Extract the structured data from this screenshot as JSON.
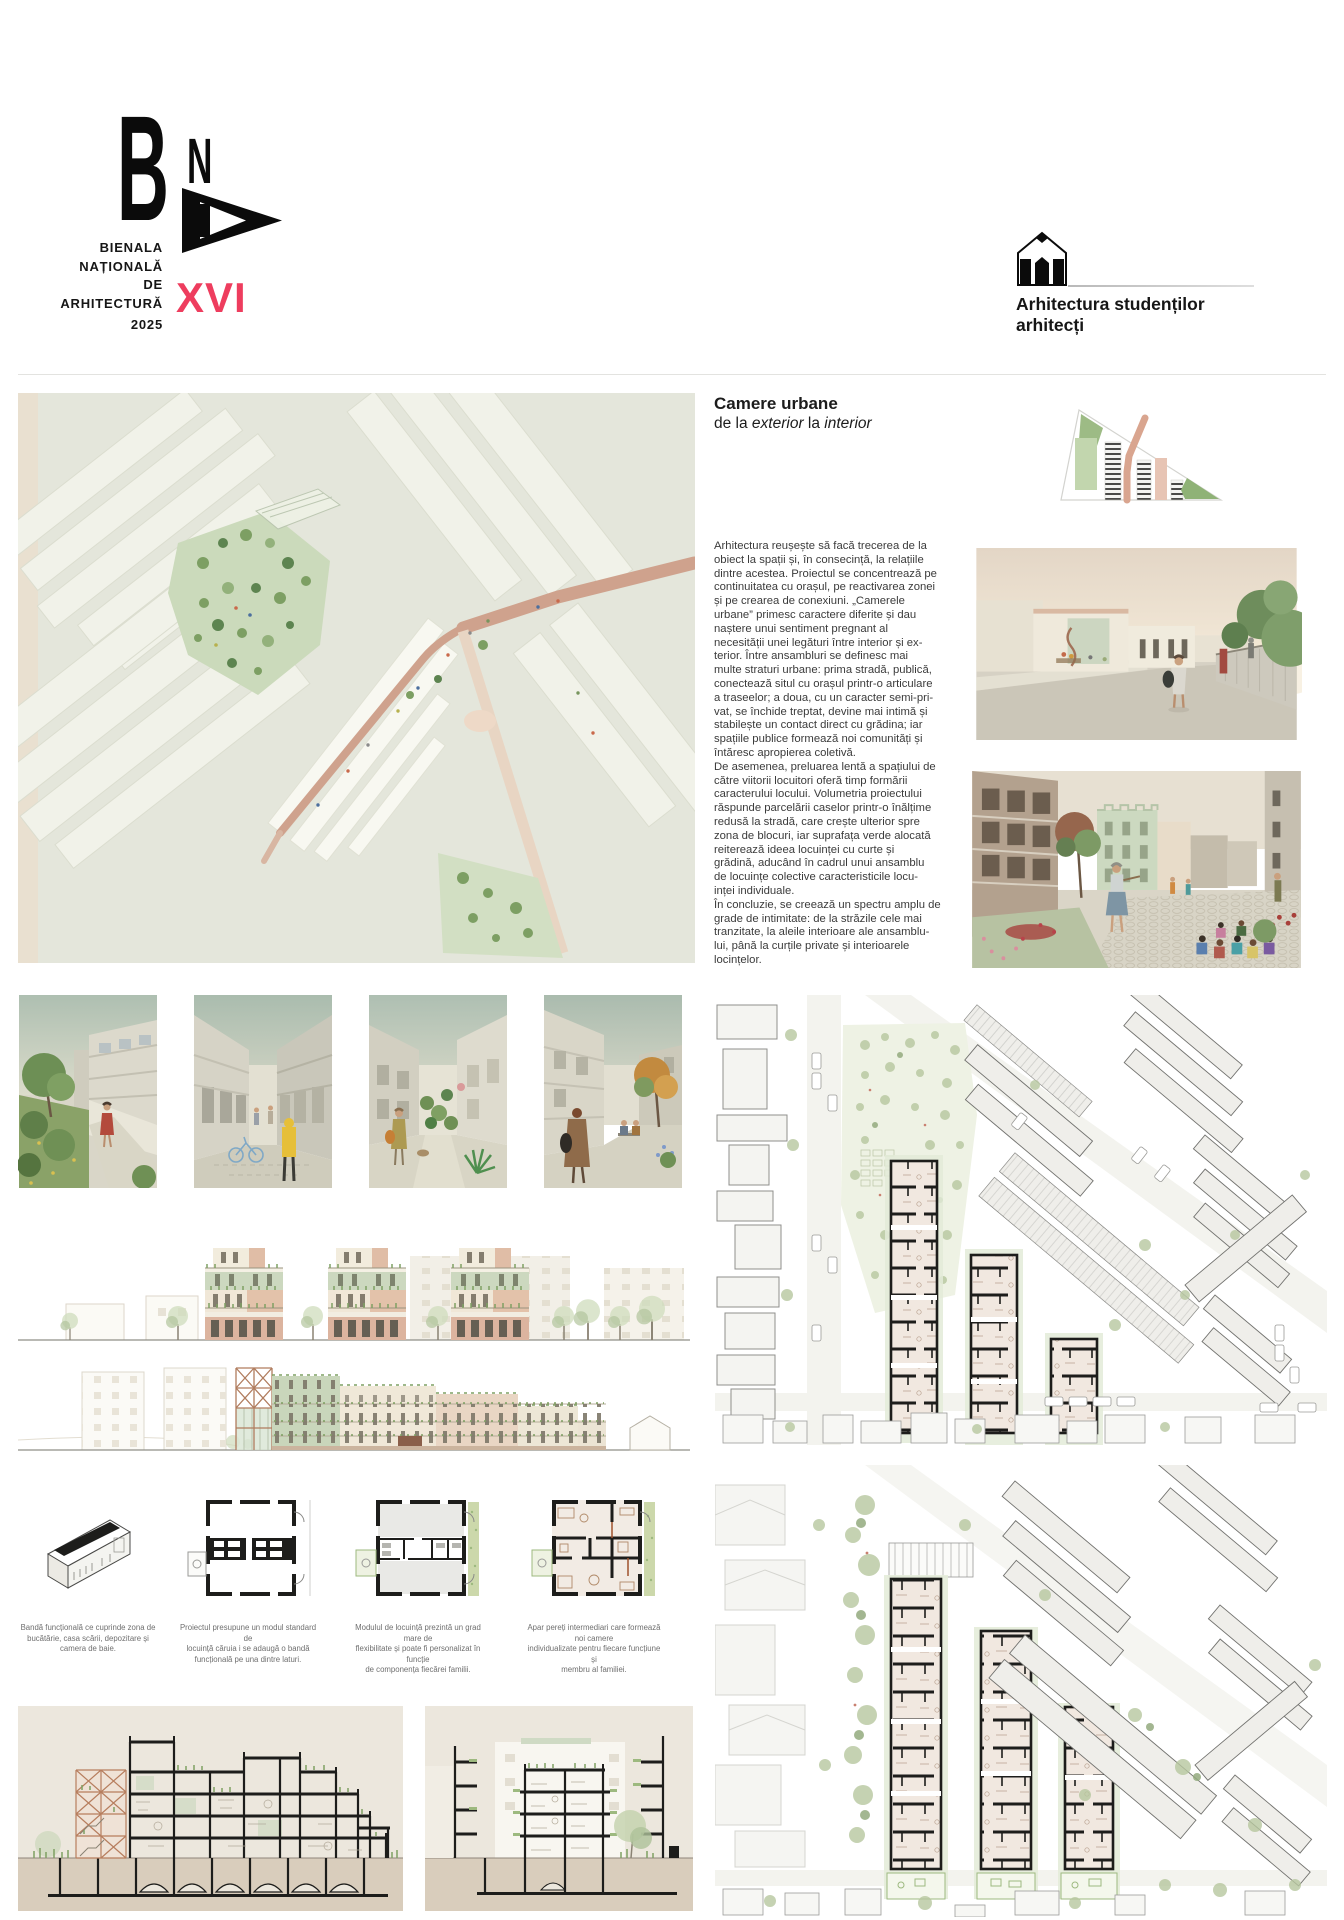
{
  "brand": {
    "letter_b": "B",
    "letter_n": "N",
    "title_lines": [
      "BIENALA",
      "NAȚIONALĂ",
      "DE",
      "ARHITECTURĂ"
    ],
    "year": "2025",
    "edition": "XVI",
    "accent_color": "#ee3d5e"
  },
  "category": {
    "label": "Arhitectura studenților arhitecți",
    "icon": "pencil-house-icon"
  },
  "project": {
    "title": "Camere urbane",
    "subtitle": {
      "pre": "de la ",
      "italic1": "exterior",
      "mid": " la ",
      "italic2": "interior"
    },
    "description": {
      "p1": "Arhitectura reușește să facă trecerea de la\nobiect la spații și, în consecință, la relațiile\ndintre acestea. Proiectul se concentrează pe\ncontinuitatea cu orașul, pe reactivarea zonei\nși pe crearea de conexiuni. „Camerele\nurbane” primesc caractere diferite și dau\nnaștere unui sentiment pregnant al\nnecesității unei legături între interior și ex-\nterior. Între ansambluri se definesc mai\nmulte straturi urbane: prima stradă, publică,\nconectează situl cu orașul printr-o articulare\na traseelor; a doua, cu un caracter semi-pri-\nvat, se închide treptat, devine mai intimă și\nstabilește un contact direct cu grădina; iar\nspațiile publice formează noi comunități și\nîntăresc apropierea coletivă.",
      "p2": "De asemenea, preluarea lentă a spațiului de\ncătre viitorii locuitori oferă timp formării\ncaracterului locului. Volumetria proiectului\nrăspunde parcelării caselor printr-o înălțime\nredusă la stradă, care crește ulterior spre\nzona de blocuri, iar suprafața verde alocată\nreiterează ideea locuinței cu curte și\ngrădină, aducând în cadrul unui ansamblu\nde locuințe colective caracteristicile locu-\ninței individuale.",
      "p3": "În concluzie, se creează un spectru amplu de\ngrade de intimitate: de la străzile cele mai\ntranzitate, la aleile interioare ale ansamblu-\nlui, până la curțile private și interioarele\nlocințelor."
    }
  },
  "plan_captions": [
    "Bandă funcțională ce cuprinde zona de\nbucătărie, casa scării, depozitare și\ncamera de baie.",
    "Proiectul presupune un modul standard de\nlocuință căruia i se adaugă o bandă\nfuncțională pe una dintre laturi.",
    "Modulul de locuință prezintă un grad mare de\nflexibilitate și poate fi personalizat în funcție\nde componența fiecărei familii.",
    "Apar pereți intermediari care formează noi camere\nindividualizate pentru fiecare funcțiune și\nmembru al familiei."
  ],
  "figures": {
    "axonometric": "axonometric-site-view",
    "site_diagram": "site-strategy-diagram",
    "render_street": "street-perspective-render",
    "render_courtyard": "courtyard-perspective-render",
    "small_renders": [
      "garden-render",
      "alley-render",
      "green-alley-render",
      "square-render"
    ],
    "elevations": [
      "street-elevation",
      "long-elevation"
    ],
    "plans": [
      "functional-band-axonometric",
      "standard-module-plan",
      "flexible-module-plan",
      "individualized-rooms-plan"
    ],
    "sections": [
      "longitudinal-section",
      "cross-section"
    ],
    "site_plans": [
      "ground-floor-site-plan",
      "upper-floor-site-plan"
    ]
  },
  "colors": {
    "accent": "#ee3d5e",
    "salmon": "#cfa28d",
    "sage_green": "#ccd9c0",
    "park_green": "#c9d9ba",
    "beige": "#e9e0d1",
    "ink": "#1d1d1b"
  }
}
